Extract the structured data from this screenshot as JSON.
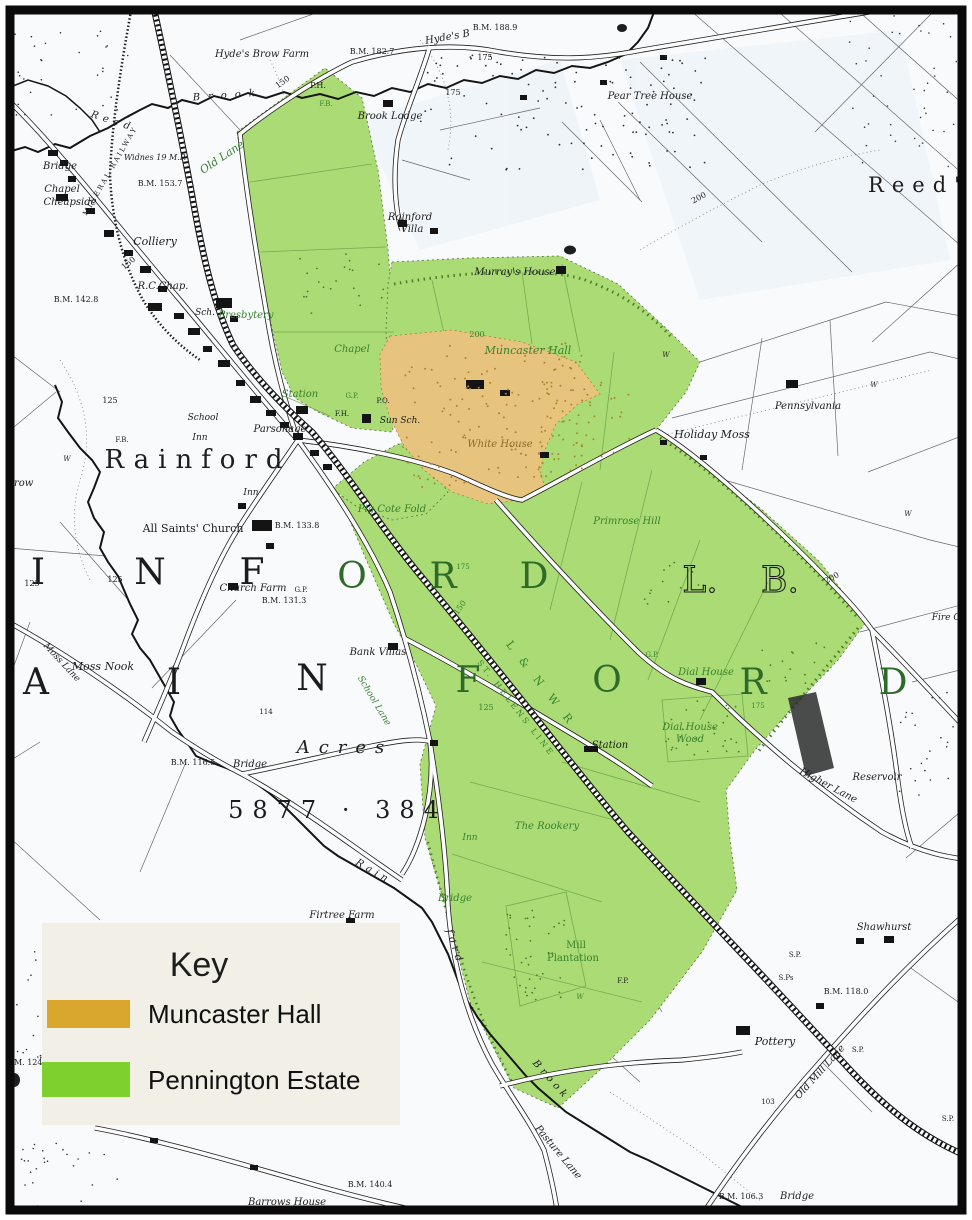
{
  "map": {
    "title": "Rainford estate map",
    "key": {
      "title": "Key",
      "items": [
        {
          "label": "Muncaster Hall",
          "color": "#d9a72e"
        },
        {
          "label": "Pennington Estate",
          "color": "#7ed02f"
        }
      ]
    },
    "colors": {
      "paper": "#f8fafc",
      "ink": "#1d1d1d",
      "green_overlay": "#abdb74",
      "orange_overlay": "#e7c47e",
      "green_label": "#37822e",
      "brown_label": "#8a6b22",
      "key_bg": "#f2efe6",
      "border": "#0a0a0a"
    },
    "labels": [
      {
        "t": "Hyde's Brow Farm",
        "x": 262,
        "y": 57
      },
      {
        "t": "Hyde's B",
        "x": 448,
        "y": 40,
        "r": -10
      },
      {
        "t": "B.M. 188.9",
        "x": 495,
        "y": 30,
        "f": "r",
        "s": 8
      },
      {
        "t": "B.M. 182.7",
        "x": 372,
        "y": 54,
        "f": "r",
        "s": 8
      },
      {
        "t": "175",
        "x": 485,
        "y": 60,
        "f": "r",
        "s": 8
      },
      {
        "t": "175",
        "x": 453,
        "y": 95,
        "f": "r",
        "s": 8
      },
      {
        "t": "Pear Tree House",
        "x": 650,
        "y": 99
      },
      {
        "t": "Reed'",
        "x": 918,
        "y": 192,
        "f": "r",
        "s": 21,
        "ls": 8
      },
      {
        "t": "Brook Lodge",
        "x": 390,
        "y": 119
      },
      {
        "t": "P.H.",
        "x": 318,
        "y": 88,
        "f": "r",
        "s": 8
      },
      {
        "t": "F.B.",
        "x": 326,
        "y": 106,
        "f": "r",
        "s": 7,
        "c": "g"
      },
      {
        "t": "150",
        "x": 284,
        "y": 84,
        "f": "r",
        "s": 8,
        "r": -35
      },
      {
        "t": "Brook",
        "x": 228,
        "y": 98,
        "ls": 8,
        "r": -4
      },
      {
        "t": "Reed",
        "x": 112,
        "y": 124,
        "ls": 5,
        "r": 18
      },
      {
        "t": "Old Lane",
        "x": 224,
        "y": 160,
        "c": "g",
        "r": -34,
        "s": 11
      },
      {
        "t": "Bridge",
        "x": 60,
        "y": 169
      },
      {
        "t": "MINERAL RAILWAY",
        "x": 112,
        "y": 172,
        "f": "r",
        "s": 7,
        "r": -60,
        "ls": 2
      },
      {
        "t": "Widnes 19 M.P.",
        "x": 155,
        "y": 160,
        "s": 8
      },
      {
        "t": "B.M. 153.7",
        "x": 160,
        "y": 186,
        "f": "r",
        "s": 8
      },
      {
        "t": "Chapel",
        "x": 62,
        "y": 192
      },
      {
        "t": "Cheapside",
        "x": 70,
        "y": 205
      },
      {
        "t": "Colliery",
        "x": 155,
        "y": 245,
        "s": 11
      },
      {
        "t": "150",
        "x": 130,
        "y": 265,
        "f": "r",
        "s": 8,
        "r": -40
      },
      {
        "t": "R.C.Chap.",
        "x": 163,
        "y": 289
      },
      {
        "t": "B.M. 142.8",
        "x": 76,
        "y": 302,
        "f": "r",
        "s": 8
      },
      {
        "t": "Sch.",
        "x": 205,
        "y": 315,
        "s": 9
      },
      {
        "t": "Presbytery",
        "x": 246,
        "y": 318,
        "c": "g"
      },
      {
        "t": "Rainford",
        "x": 410,
        "y": 220
      },
      {
        "t": "Villa",
        "x": 412,
        "y": 232
      },
      {
        "t": "Murray's House",
        "x": 515,
        "y": 275
      },
      {
        "t": "200",
        "x": 700,
        "y": 200,
        "f": "r",
        "s": 8,
        "r": -28
      },
      {
        "t": "Chapel",
        "x": 352,
        "y": 352,
        "c": "g"
      },
      {
        "t": "Muncaster Hall",
        "x": 528,
        "y": 354,
        "c": "g",
        "s": 11
      },
      {
        "t": "200",
        "x": 477,
        "y": 337,
        "f": "r",
        "s": 8,
        "c": "g"
      },
      {
        "t": "Station",
        "x": 300,
        "y": 397,
        "c": "g"
      },
      {
        "t": "G.P.",
        "x": 352,
        "y": 398,
        "f": "r",
        "s": 7,
        "c": "g"
      },
      {
        "t": "P.O.",
        "x": 383,
        "y": 403,
        "f": "r",
        "s": 7
      },
      {
        "t": "F.H.",
        "x": 342,
        "y": 416,
        "f": "r",
        "s": 7
      },
      {
        "t": "Sun Sch.",
        "x": 400,
        "y": 423,
        "s": 9
      },
      {
        "t": "Parsonage",
        "x": 280,
        "y": 432
      },
      {
        "t": "White House",
        "x": 500,
        "y": 447,
        "c": "b"
      },
      {
        "t": "School",
        "x": 203,
        "y": 420,
        "s": 9
      },
      {
        "t": "Inn",
        "x": 200,
        "y": 440,
        "s": 9
      },
      {
        "t": "Inn",
        "x": 251,
        "y": 495,
        "s": 9
      },
      {
        "t": "Rainford",
        "x": 198,
        "y": 468,
        "f": "r",
        "s": 26,
        "ls": 9
      },
      {
        "t": "All Saints' Church",
        "x": 193,
        "y": 532,
        "f": "r",
        "s": 11
      },
      {
        "t": "B.M. 133.8",
        "x": 297,
        "y": 528,
        "f": "r",
        "s": 8
      },
      {
        "t": "Church Farm",
        "x": 253,
        "y": 591
      },
      {
        "t": "G.P.",
        "x": 301,
        "y": 592,
        "f": "r",
        "s": 7
      },
      {
        "t": "B.M. 131.3",
        "x": 284,
        "y": 603,
        "f": "r",
        "s": 8
      },
      {
        "t": "125",
        "x": 110,
        "y": 403,
        "f": "r",
        "s": 8
      },
      {
        "t": "125",
        "x": 115,
        "y": 582,
        "f": "r",
        "s": 8
      },
      {
        "t": "125",
        "x": 32,
        "y": 586,
        "f": "r",
        "s": 8
      },
      {
        "t": "Brow",
        "x": 20,
        "y": 486
      },
      {
        "t": "W",
        "x": 67,
        "y": 461,
        "s": 7
      },
      {
        "t": "F.B.",
        "x": 122,
        "y": 442,
        "f": "r",
        "s": 7
      },
      {
        "t": "Moss Nook",
        "x": 103,
        "y": 670,
        "s": 11
      },
      {
        "t": "Moss Lane",
        "x": 60,
        "y": 664,
        "s": 9,
        "r": 47
      },
      {
        "t": "Bank Villas",
        "x": 378,
        "y": 655
      },
      {
        "t": "School Lane",
        "x": 372,
        "y": 702,
        "s": 9,
        "c": "g",
        "r": 59
      },
      {
        "t": "Acres",
        "x": 345,
        "y": 753,
        "s": 18,
        "ls": 9
      },
      {
        "t": "114",
        "x": 266,
        "y": 714,
        "f": "r",
        "s": 7
      },
      {
        "t": "B.M. 116.5",
        "x": 193,
        "y": 765,
        "f": "r",
        "s": 8
      },
      {
        "t": "Bridge",
        "x": 250,
        "y": 767
      },
      {
        "t": "5877 · 384",
        "x": 338,
        "y": 818,
        "f": "r",
        "s": 24,
        "ls": 9
      },
      {
        "t": "Primrose Hill",
        "x": 627,
        "y": 524,
        "c": "g"
      },
      {
        "t": "Pig Cote Fold",
        "x": 392,
        "y": 512,
        "c": "g"
      },
      {
        "t": "Holiday Moss",
        "x": 712,
        "y": 438,
        "s": 11
      },
      {
        "t": "Pennsylvania",
        "x": 808,
        "y": 409
      },
      {
        "t": "W",
        "x": 874,
        "y": 387,
        "s": 7
      },
      {
        "t": "W",
        "x": 908,
        "y": 516,
        "s": 7
      },
      {
        "t": "W",
        "x": 666,
        "y": 357,
        "s": 7
      },
      {
        "t": "Dial House",
        "x": 706,
        "y": 675,
        "c": "g"
      },
      {
        "t": "Dial House",
        "x": 690,
        "y": 730,
        "c": "g"
      },
      {
        "t": "Wood",
        "x": 690,
        "y": 742,
        "c": "g"
      },
      {
        "t": "175",
        "x": 758,
        "y": 708,
        "f": "r",
        "s": 7,
        "c": "g"
      },
      {
        "t": "Station",
        "x": 610,
        "y": 748
      },
      {
        "t": "G.P.",
        "x": 652,
        "y": 657,
        "f": "r",
        "s": 7,
        "c": "g"
      },
      {
        "t": "150",
        "x": 462,
        "y": 609,
        "f": "r",
        "s": 8,
        "c": "g",
        "r": -55
      },
      {
        "t": "125",
        "x": 486,
        "y": 710,
        "f": "r",
        "s": 8,
        "c": "g"
      },
      {
        "t": "175",
        "x": 463,
        "y": 569,
        "f": "r",
        "s": 7,
        "c": "g"
      },
      {
        "t": "L & N W R",
        "x": 538,
        "y": 686,
        "c": "g",
        "r": 52,
        "ls": 5,
        "s": 11,
        "f": "r"
      },
      {
        "t": "ST. HELENS LINE",
        "x": 514,
        "y": 710,
        "c": "g",
        "r": 52,
        "ls": 3,
        "s": 8,
        "f": "r"
      },
      {
        "t": "The Rookery",
        "x": 547,
        "y": 829,
        "c": "g"
      },
      {
        "t": "Inn",
        "x": 470,
        "y": 840,
        "s": 9,
        "c": "g"
      },
      {
        "t": "Bridge",
        "x": 455,
        "y": 901,
        "c": "g"
      },
      {
        "t": "W",
        "x": 580,
        "y": 999,
        "s": 7,
        "c": "g"
      },
      {
        "t": "F.P.",
        "x": 623,
        "y": 983,
        "f": "r",
        "s": 7
      },
      {
        "t": "Mill",
        "x": 576,
        "y": 948,
        "f": "r",
        "c": "g"
      },
      {
        "t": "Plantation",
        "x": 573,
        "y": 961,
        "f": "r",
        "c": "g"
      },
      {
        "t": "Firtree Farm",
        "x": 342,
        "y": 918
      },
      {
        "t": "Rain",
        "x": 372,
        "y": 874,
        "ls": 4,
        "r": 30
      },
      {
        "t": "ford",
        "x": 452,
        "y": 948,
        "ls": 4,
        "r": 72
      },
      {
        "t": "Brook",
        "x": 549,
        "y": 1082,
        "ls": 4,
        "r": 48
      },
      {
        "t": "Shawhurst",
        "x": 884,
        "y": 930
      },
      {
        "t": "Pottery",
        "x": 775,
        "y": 1045,
        "s": 11
      },
      {
        "t": "B.M. 118.0",
        "x": 846,
        "y": 994,
        "f": "r",
        "s": 8
      },
      {
        "t": "S.P.",
        "x": 795,
        "y": 957,
        "f": "r",
        "s": 7
      },
      {
        "t": "S.Ps",
        "x": 786,
        "y": 980,
        "f": "r",
        "s": 7
      },
      {
        "t": "S.P.",
        "x": 858,
        "y": 1052,
        "f": "r",
        "s": 7
      },
      {
        "t": "S.P.",
        "x": 948,
        "y": 1121,
        "f": "r",
        "s": 7
      },
      {
        "t": "Old Mill Lane",
        "x": 822,
        "y": 1074,
        "r": -48
      },
      {
        "t": "103",
        "x": 768,
        "y": 1104,
        "f": "r",
        "s": 7
      },
      {
        "t": "B.M. 106.3",
        "x": 741,
        "y": 1199,
        "f": "r",
        "s": 8
      },
      {
        "t": "Bridge",
        "x": 797,
        "y": 1199
      },
      {
        "t": "B.M. 140.4",
        "x": 370,
        "y": 1187,
        "f": "r",
        "s": 8
      },
      {
        "t": "Barrows House",
        "x": 287,
        "y": 1205
      },
      {
        "t": "Pasture Lane",
        "x": 556,
        "y": 1154,
        "r": 50
      },
      {
        "t": "B.M. 124",
        "x": 24,
        "y": 1065,
        "f": "r",
        "s": 8
      },
      {
        "t": "Reservoir",
        "x": 877,
        "y": 780
      },
      {
        "t": "Higher Lane",
        "x": 827,
        "y": 788,
        "r": 28
      },
      {
        "t": "Fire C",
        "x": 946,
        "y": 620,
        "s": 9
      },
      {
        "t": "200",
        "x": 833,
        "y": 580,
        "f": "r",
        "s": 8,
        "r": -30
      }
    ],
    "big_letters": [
      {
        "t": "I",
        "x": 38,
        "y": 584,
        "c": "k"
      },
      {
        "t": "N",
        "x": 150,
        "y": 584,
        "c": "k"
      },
      {
        "t": "F",
        "x": 252,
        "y": 584,
        "c": "k"
      },
      {
        "t": "O",
        "x": 352,
        "y": 588,
        "c": "gg"
      },
      {
        "t": "R",
        "x": 443,
        "y": 588,
        "c": "gg"
      },
      {
        "t": "D",
        "x": 534,
        "y": 588,
        "c": "gg"
      },
      {
        "t": "L.",
        "x": 700,
        "y": 592,
        "c": "h"
      },
      {
        "t": "B.",
        "x": 780,
        "y": 592,
        "c": "h"
      },
      {
        "t": "A",
        "x": 36,
        "y": 694,
        "c": "k"
      },
      {
        "t": "I",
        "x": 174,
        "y": 694,
        "c": "k"
      },
      {
        "t": "N",
        "x": 312,
        "y": 690,
        "c": "k"
      },
      {
        "t": "F",
        "x": 468,
        "y": 692,
        "c": "gg"
      },
      {
        "t": "O",
        "x": 607,
        "y": 692,
        "c": "gg"
      },
      {
        "t": "R",
        "x": 753,
        "y": 694,
        "c": "gg"
      },
      {
        "t": "D",
        "x": 893,
        "y": 694,
        "c": "gg"
      }
    ]
  }
}
